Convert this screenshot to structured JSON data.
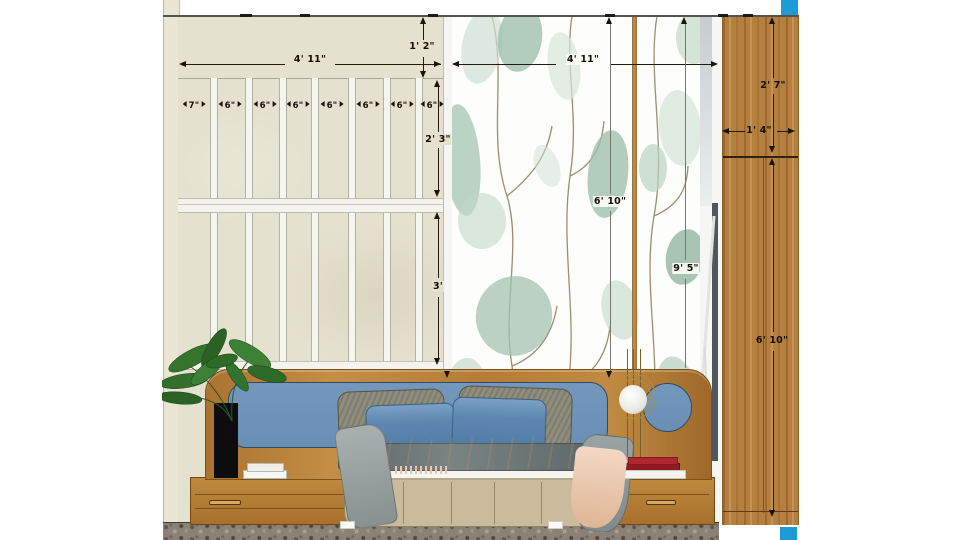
{
  "palette": {
    "wall_beige": "#e4e1ce",
    "wardrobe_wood": "#b5803f",
    "headboard_wood": "#b57d36",
    "headboard_panel_blue": "#7094ba",
    "pillow_blue": "#5d87b0",
    "marker_cyan": "#1d9bd7",
    "floor_granite": "#8b8177",
    "wallpaper_leaf_green": "#a3c2b0",
    "dimension_text": "#150e05"
  },
  "dims": {
    "left_wall_width": "4' 11\"",
    "wallpaper_width": "4' 11\"",
    "top_band_height": "1' 2\"",
    "slat_upper_height": "2' 3\"",
    "slat_lower_height": "3'",
    "slat_segments": [
      "7\"",
      "6\"",
      "6\"",
      "6\"",
      "6\"",
      "6\"",
      "6\"",
      "6\""
    ],
    "wallpaper_height": "6' 10\"",
    "wall_full_height": "9' 5\"",
    "wardrobe_upper_height": "2' 7\"",
    "wardrobe_width": "1' 4\"",
    "wardrobe_lower_height": "6' 10\""
  }
}
